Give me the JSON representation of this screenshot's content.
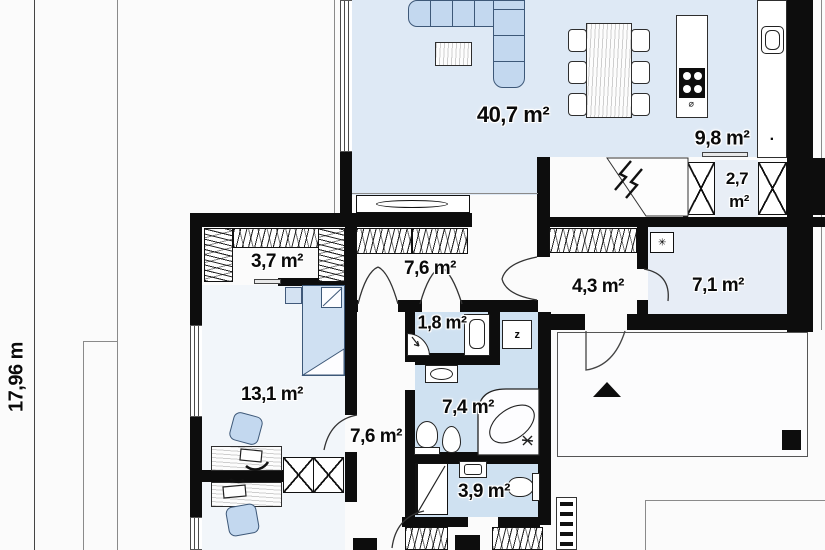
{
  "plan_title": "floor-plan",
  "dimension": {
    "label": "17,96 m"
  },
  "rooms": [
    {
      "id": "living-room",
      "area_label": "40,7 m²"
    },
    {
      "id": "kitchen",
      "area_label": "9,8 m²"
    },
    {
      "id": "pantry",
      "area_line1": "2,7",
      "area_line2": "m²"
    },
    {
      "id": "wardrobe",
      "area_label": "3,7 m²"
    },
    {
      "id": "hall",
      "area_label": "7,6 m²"
    },
    {
      "id": "wc",
      "area_label": "1,8 m²"
    },
    {
      "id": "vestibule",
      "area_label": "4,3 m²"
    },
    {
      "id": "utility-room",
      "area_label": "7,1 m²"
    },
    {
      "id": "bedroom",
      "area_label": "13,1 m²"
    },
    {
      "id": "corridor",
      "area_label": "7,6 m²"
    },
    {
      "id": "bathroom",
      "area_label": "7,4 m²"
    },
    {
      "id": "shower-room",
      "area_label": "3,9 m²"
    }
  ],
  "symbols": {
    "washing_machine": "z",
    "boiler": "✳",
    "hob_diameter": "⌀",
    "kitchen_dot": "·"
  },
  "colors": {
    "wall": "#0d0d0d",
    "floor_blue": "#dee9f5",
    "floor_bath": "#cfe1f1",
    "floor_light": "#f2f6fa",
    "furniture_blue": "#c3d8ef",
    "background": "#fbfbfb"
  }
}
